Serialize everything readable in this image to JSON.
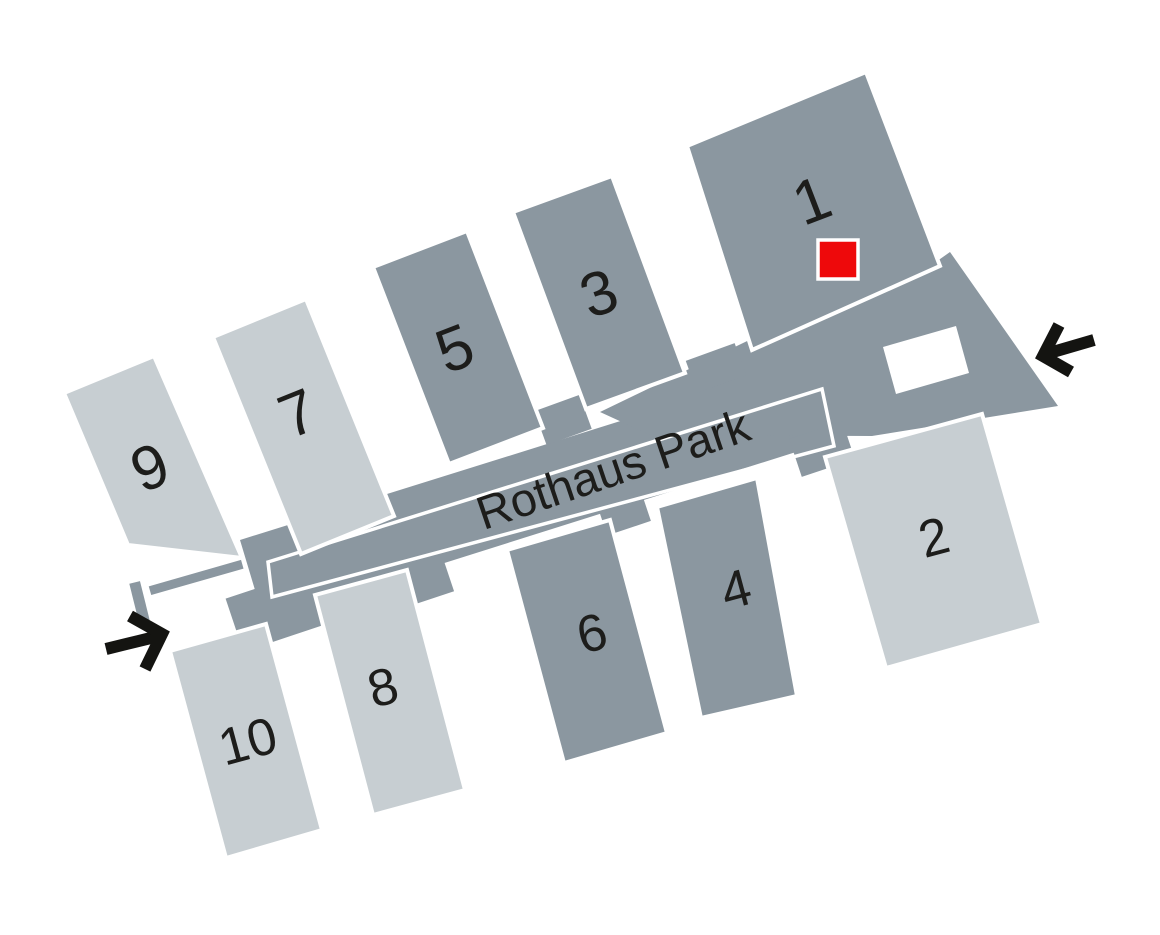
{
  "map": {
    "title": "Rothaus Park",
    "buildings": [
      {
        "id": "1",
        "label": "1",
        "shade": "dark"
      },
      {
        "id": "2",
        "label": "2",
        "shade": "light"
      },
      {
        "id": "3",
        "label": "3",
        "shade": "dark"
      },
      {
        "id": "4",
        "label": "4",
        "shade": "dark"
      },
      {
        "id": "5",
        "label": "5",
        "shade": "dark"
      },
      {
        "id": "6",
        "label": "6",
        "shade": "dark"
      },
      {
        "id": "7",
        "label": "7",
        "shade": "light"
      },
      {
        "id": "8",
        "label": "8",
        "shade": "light"
      },
      {
        "id": "9",
        "label": "9",
        "shade": "light"
      },
      {
        "id": "10",
        "label": "10",
        "shade": "light"
      }
    ],
    "marker": {
      "shape": "red-square",
      "on_building": "1",
      "color": "#ee090b"
    },
    "entrances": [
      {
        "id": "left",
        "direction": "pointing-right-into-park"
      },
      {
        "id": "right",
        "direction": "pointing-left-into-park"
      }
    ],
    "colors": {
      "building_dark": "#8b97a0",
      "building_light": "#c7ced2",
      "path_band": "#8b97a0",
      "marker_red": "#ee090b",
      "label_text": "#1d1d1b",
      "arrow_black": "#141411",
      "background": "#ffffff",
      "path_outline_white": "#ffffff"
    }
  }
}
